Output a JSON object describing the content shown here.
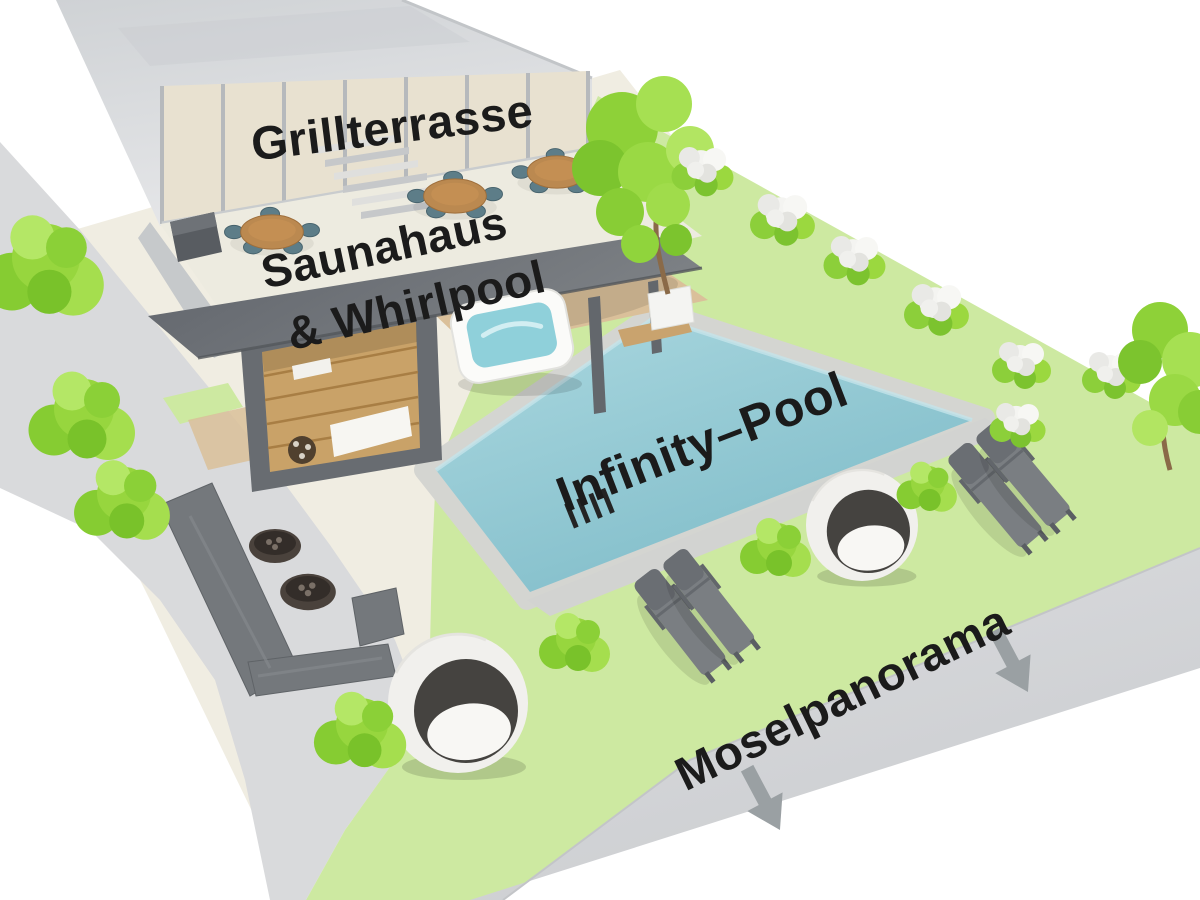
{
  "scene": {
    "type": "isometric-wellness-garden-plan",
    "labels": {
      "grill_terrace": "Grillterrasse",
      "sauna_line1": "Saunahaus",
      "sauna_line2": "& Whirlpool",
      "infinity_pool": "Infinity–Pool",
      "mosel_panorama": "Moselpanorama"
    },
    "label_text_color": "#1b1b1b",
    "arrows": {
      "count": 2,
      "direction": "down",
      "color": "#9aa0a3"
    },
    "colors": {
      "background": "#ffffff",
      "ground_cream": "#f0ede2",
      "walkway": "#d9dadc",
      "lawn": "#cde9a1",
      "platform_edge": "#d3d5d7",
      "pool_water": "#8cc5d1",
      "pool_water_light": "#a8d6de",
      "pool_water_dark": "#7cbac7",
      "pool_coping": "#d6d7d3",
      "building_wall": "#d6d8da",
      "window_glass": "#e8e1d0",
      "terrace_floor": "#edebe0",
      "structure_dark": "#6d7176",
      "wood_deck": "#dac09a",
      "sauna_wood": "#c9a268",
      "whirlpool_water": "#8fd0da",
      "furniture_gray": "#75797d",
      "egg_chair_shell": "#f1f0ed",
      "egg_chair_inner": "#454340",
      "foliage_green": "#97d63e",
      "flower_white": "#f4f4f1",
      "table_wood": "#bb8950",
      "chair_teal": "#5d7d88",
      "fire_table": "#4a423c"
    },
    "inventory": {
      "dining_tables": 3,
      "sauna_house": 1,
      "whirlpool": 1,
      "infinity_pool": 1,
      "egg_chairs": 2,
      "sun_loungers": 4,
      "lounge_sofa": 1,
      "fire_tables": 2,
      "down_arrows": 2
    }
  }
}
